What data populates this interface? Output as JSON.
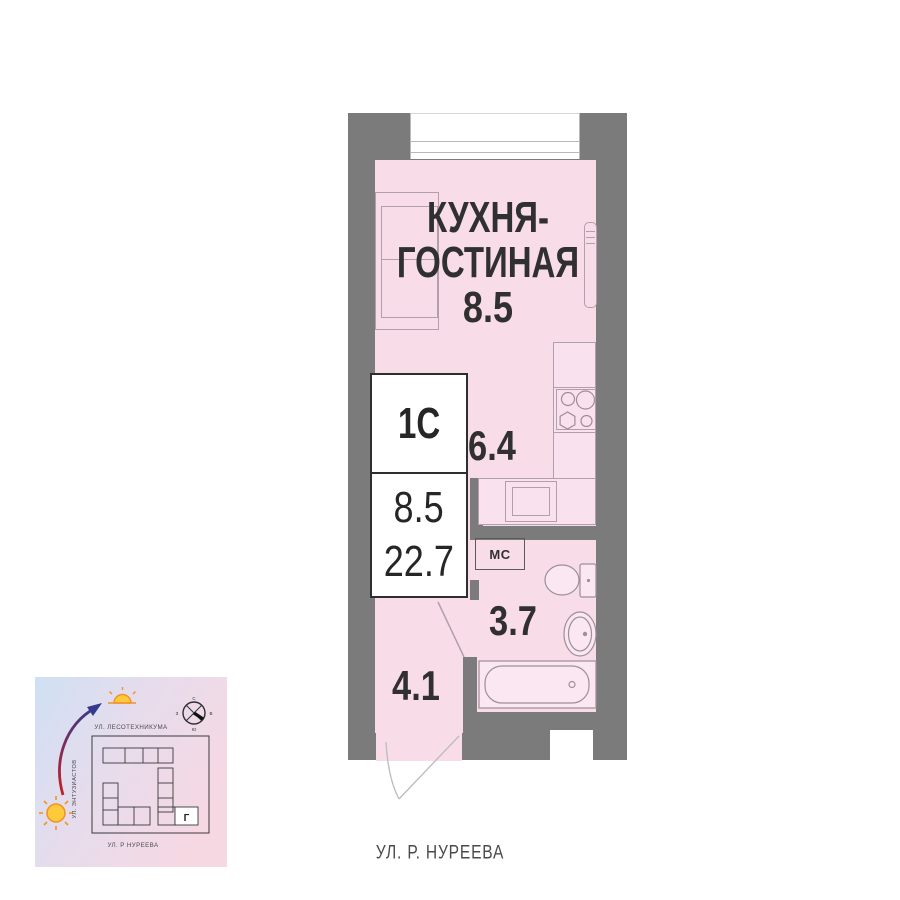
{
  "floor_plan": {
    "room_title": [
      "КУХНЯ-",
      "ГОСТИНАЯ"
    ],
    "areas": {
      "kitchen_living": "8.5",
      "kitchen": "6.4",
      "bathroom": "3.7",
      "hallway": "4.1"
    },
    "washer_label": "МС",
    "info_card": {
      "unit_type": "1С",
      "living_area": "8.5",
      "total_area": "22.7"
    },
    "street": "УЛ. Р. НУРЕЕВА"
  },
  "inset_map": {
    "street_top": "УЛ. ЛЕСОТЕХНИКУМА",
    "street_left": "УЛ. ЭНТУЗИАСТОВ",
    "street_bottom": "УЛ. Р НУРЕЕВА",
    "building_label": "Г",
    "compass": {
      "n": "С",
      "e": "В",
      "s": "Ю",
      "w": "З"
    }
  },
  "colors": {
    "wall": "#7b7b7b",
    "room_fill": "#f8dce8",
    "fixture_fill": "#fbe7f1",
    "outline": "#b1a0ac",
    "text": "#303030"
  }
}
